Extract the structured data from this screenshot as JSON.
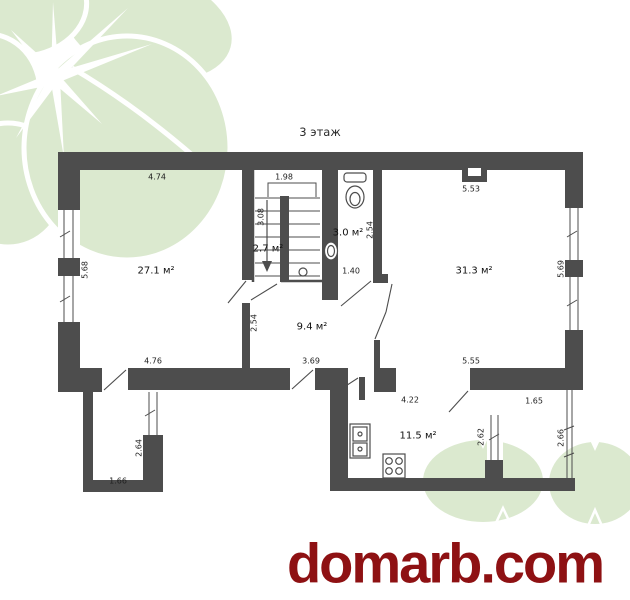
{
  "title": "3 этаж",
  "watermark": {
    "text": "domarb.com",
    "color": "#8e1113"
  },
  "colors": {
    "wall": "#4d4d4d",
    "leaf": "#dbe9cf",
    "label": "#1f1f1f"
  },
  "rooms": [
    {
      "name": "living-room",
      "label": "27.1 м²"
    },
    {
      "name": "stairwell",
      "label": "2.7 м²"
    },
    {
      "name": "bathroom",
      "label": "3.0 м²"
    },
    {
      "name": "big-room",
      "label": "31.3 м²"
    },
    {
      "name": "hallway",
      "label": "9.4 м²"
    },
    {
      "name": "kitchen",
      "label": "11.5 м²"
    }
  ],
  "dimensions": [
    {
      "value": "4.74"
    },
    {
      "value": "1.98"
    },
    {
      "value": "5.53"
    },
    {
      "value": "5.68"
    },
    {
      "value": "3.08"
    },
    {
      "value": "2.54"
    },
    {
      "value": "1.40"
    },
    {
      "value": "5.69"
    },
    {
      "value": "2.54"
    },
    {
      "value": "4.76"
    },
    {
      "value": "3.69"
    },
    {
      "value": "5.55"
    },
    {
      "value": "4.22"
    },
    {
      "value": "1.65"
    },
    {
      "value": "2.64"
    },
    {
      "value": "1.66"
    },
    {
      "value": "2.62"
    },
    {
      "value": "2.66"
    }
  ]
}
